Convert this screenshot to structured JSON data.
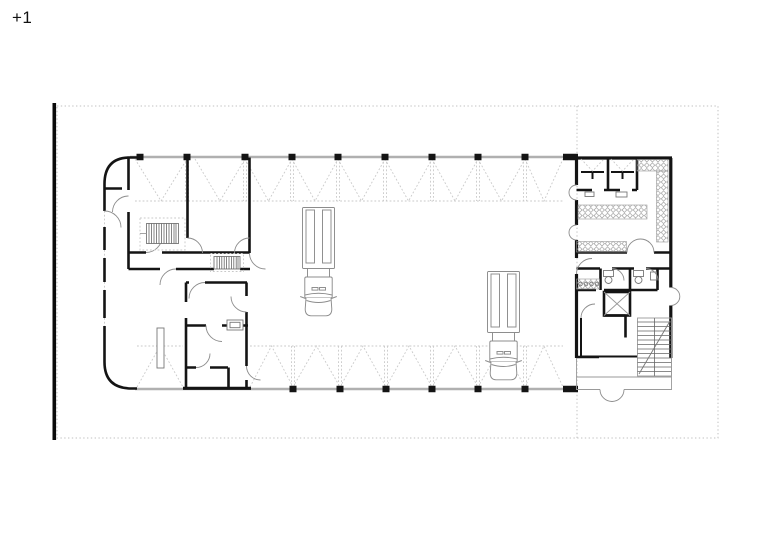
{
  "plan": {
    "level_label": "+1",
    "drawing_type": "architectural-floor-plan",
    "features": {
      "site_boundary": "thick-black-line-left",
      "plot_outline": "dotted-rectangle",
      "phase_divider": "dotted-vertical-line",
      "vehicle_hall": "open-hall-with-folding-door-bays-top-and-bottom",
      "vehicles": [
        "fire-truck-top-view",
        "fire-truck-top-view"
      ],
      "stairs": [
        "left-wing-stair",
        "left-wing-small-stair",
        "right-block-dogleg-stair"
      ],
      "elevator": "x-marked-shaft",
      "locker_room": "diamond-hatched-shelving-bands"
    }
  },
  "theme": {
    "background": "#ffffff",
    "ink": "#141414",
    "wall-gray": "#b0b0b0",
    "dash-gray": "#c9c9c9",
    "detail-gray": "#8c8c8c",
    "tread-gray": "#9a9a9a"
  }
}
